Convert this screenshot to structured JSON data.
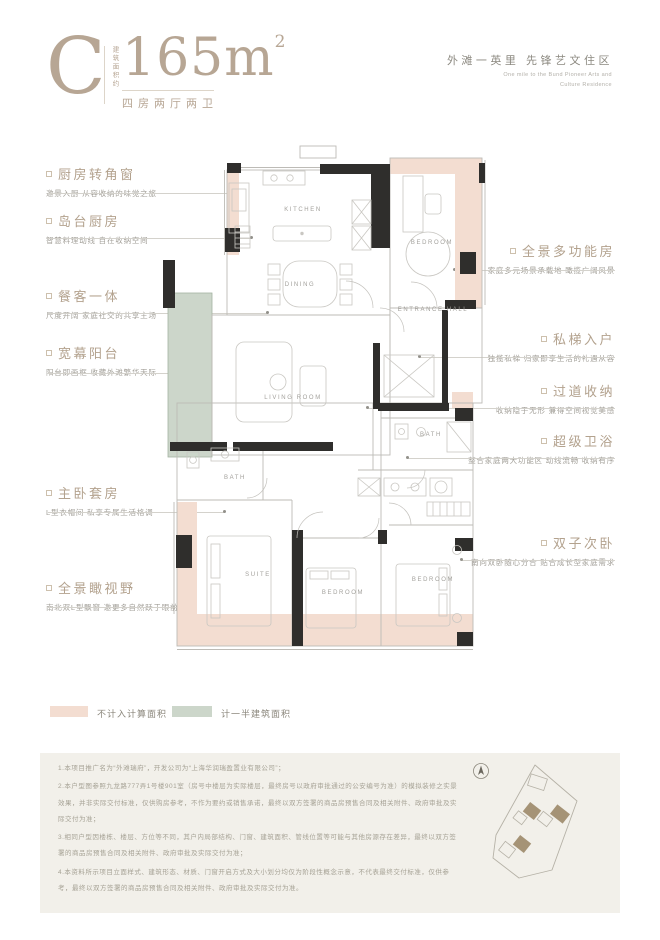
{
  "header": {
    "type_letter": "C",
    "area_note_vertical": "建筑面积约",
    "area_value": "165m",
    "area_sup": "2",
    "layout_text": "四房两厅两卫",
    "tagline_cn": "外滩一英里  先锋艺文住区",
    "tagline_en_1": "One mile to the Bund Pioneer Arts and",
    "tagline_en_2": "Culture Residence"
  },
  "annotations_left": [
    {
      "title": "厨房转角窗",
      "subtitle": "邀景入厨 从容收纳的味觉之旅"
    },
    {
      "title": "岛台厨房",
      "subtitle": "智慧料理动线 自在收纳空间"
    },
    {
      "title": "餐客一体",
      "subtitle": "尺度开阔 家庭社交的共享主场"
    },
    {
      "title": "宽幕阳台",
      "subtitle": "阳台即画框 收藏外滩繁华天际"
    },
    {
      "title": "主卧套房",
      "subtitle": "L型衣帽间 私享专属生活格调"
    },
    {
      "title": "全景瞰视野",
      "subtitle": "南北双L型飘窗 邀更多自然跃于眼前"
    }
  ],
  "annotations_right": [
    {
      "title": "全景多功能房",
      "subtitle": "家庭多元场景承载地 瞰揽广阔风景"
    },
    {
      "title": "私梯入户",
      "subtitle": "独揽私梯 归家即享生活的礼遇从容"
    },
    {
      "title": "过道收纳",
      "subtitle": "收纳隐于无形 兼得空间视觉美感"
    },
    {
      "title": "超级卫浴",
      "subtitle": "整合家庭两大功能区 动线流畅 收纳有序"
    },
    {
      "title": "双子次卧",
      "subtitle": "南向双卧随心分合 贴合成长型家庭需求"
    }
  ],
  "plan": {
    "rooms": {
      "kitchen": "KITCHEN",
      "dining": "DINING",
      "living": "LIVING ROOM",
      "bedroom_top": "BEDROOM",
      "entrance": "ENTRANCE HALL",
      "bath_left": "BATH",
      "bath_right": "BATH",
      "suite": "SUITE",
      "bedroom_mid": "BEDROOM",
      "bedroom_right": "BEDROOM"
    }
  },
  "legend": [
    {
      "label": "不计入计算面积",
      "color": "#f3ddd1"
    },
    {
      "label": "计一半建筑面积",
      "color": "#ccd6ca"
    }
  ],
  "disclaimer": {
    "p1": "1.本项目推广名为“外滩瑞府”，开发公司为“上海华润瑞盈置业有限公司”；",
    "p2": "2.本户型图参照九龙路777弄1号楼901室（房号中楼层为实际楼层，最终房号以政府审批通过的公安编号为准）的模拟装修之实景效果，并非实际交付标准，仅供购房参考，不作为要约或销售承诺，最终以双方签署的商品房预售合同及相关附件、政府审批及实际交付为准；",
    "p3": "3.相同户型因楼栋、楼层、方位等不同，其户内局部结构、门窗、建筑面积、管线位置等可能与其他房源存在差异，最终以双方签署的商品房预售合同及相关附件、政府审批及实际交付为准；",
    "p4": "4.本资料所示项目立面样式、建筑形态、材质、门窗开启方式及大小划分均仅为阶段性概念示意，不代表最终交付标准，仅供参考，最终以双方签署的商品房预售合同及相关附件、政府审批及实际交付为准。"
  },
  "colors": {
    "accent": "#b3a28e",
    "pink_zone": "#f3ddd1",
    "green_zone": "#ccd6ca",
    "wall": "#2f2e2c",
    "note_bg": "#f2f0ea"
  }
}
